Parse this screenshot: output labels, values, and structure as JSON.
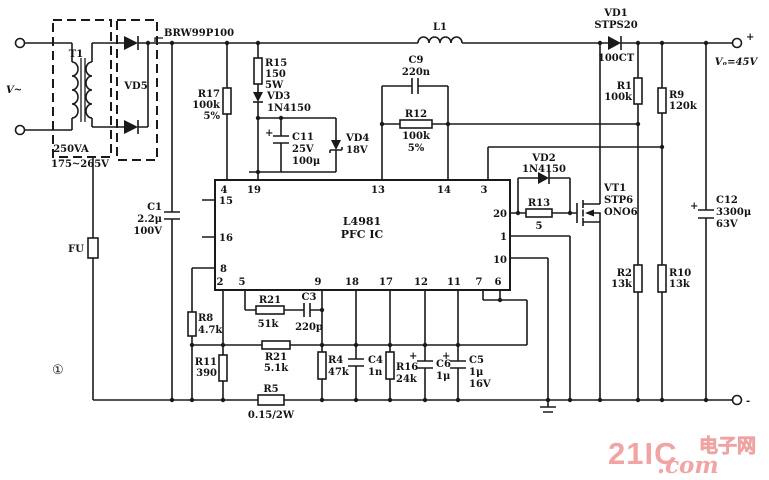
{
  "figure": {
    "circled_index": "①"
  },
  "power_input": {
    "source_label": "V~",
    "terminal_plus": "+",
    "terminal_minus": "-",
    "output_label": "Vₒ=45V"
  },
  "transformer": {
    "name": "T1",
    "rating": "250VA",
    "range": "175~265V"
  },
  "bridge": {
    "name": "VD5",
    "part": "BRW99P100"
  },
  "fuse": {
    "name": "FU"
  },
  "ic": {
    "name": "L4981",
    "type": "PFC IC",
    "pins_top": [
      "4",
      "19",
      "13",
      "14",
      "3"
    ],
    "pins_left": [
      "15",
      "16",
      "8"
    ],
    "pins_right": [
      "20",
      "1",
      "10"
    ],
    "pins_bottom": [
      "2",
      "5",
      "9",
      "18",
      "17",
      "12",
      "11",
      "7",
      "6"
    ]
  },
  "components": {
    "r17": [
      "R17",
      "100k",
      "5%"
    ],
    "r15": [
      "R15",
      "150",
      "5W"
    ],
    "vd3": [
      "VD3",
      "1N4150"
    ],
    "c11": [
      "C11",
      "25V",
      "100μ"
    ],
    "vd4": [
      "VD4",
      "18V"
    ],
    "c1": [
      "C1",
      "2.2μ",
      "100V"
    ],
    "c9": [
      "C9",
      "220n"
    ],
    "r12": [
      "R12",
      "100k",
      "5%"
    ],
    "l1": [
      "L1"
    ],
    "vd1": [
      "VD1",
      "STPS20",
      "100CT"
    ],
    "r1": [
      "R1",
      "100k"
    ],
    "r9": [
      "R9",
      "120k"
    ],
    "vd2": [
      "VD2",
      "1N4150"
    ],
    "r13": [
      "R13",
      "5"
    ],
    "vt1": [
      "VT1",
      "STP6",
      "ONO6"
    ],
    "c12": [
      "C12",
      "3300μ",
      "63V"
    ],
    "r2": [
      "R2",
      "13k"
    ],
    "r10": [
      "R10",
      "13k"
    ],
    "r8": [
      "R8",
      "4.7k"
    ],
    "r11": [
      "R11",
      "390"
    ],
    "r21a": [
      "R21",
      "51k"
    ],
    "c3": [
      "C3",
      "220p"
    ],
    "r21b": [
      "R21",
      "5.1k"
    ],
    "r4": [
      "R4",
      "47k"
    ],
    "c4": [
      "C4",
      "1n"
    ],
    "r16": [
      "R16",
      "24k"
    ],
    "c6": [
      "C6",
      "1μ"
    ],
    "c5": [
      "C5",
      "1μ",
      "16V"
    ],
    "r5": [
      "R5",
      "0.15/2W"
    ]
  },
  "symbols": {
    "plus": "+"
  },
  "watermark": {
    "brand": "21IC",
    "cn": "电子网",
    "suffix": ".com",
    "color": "#f2a4a4"
  }
}
